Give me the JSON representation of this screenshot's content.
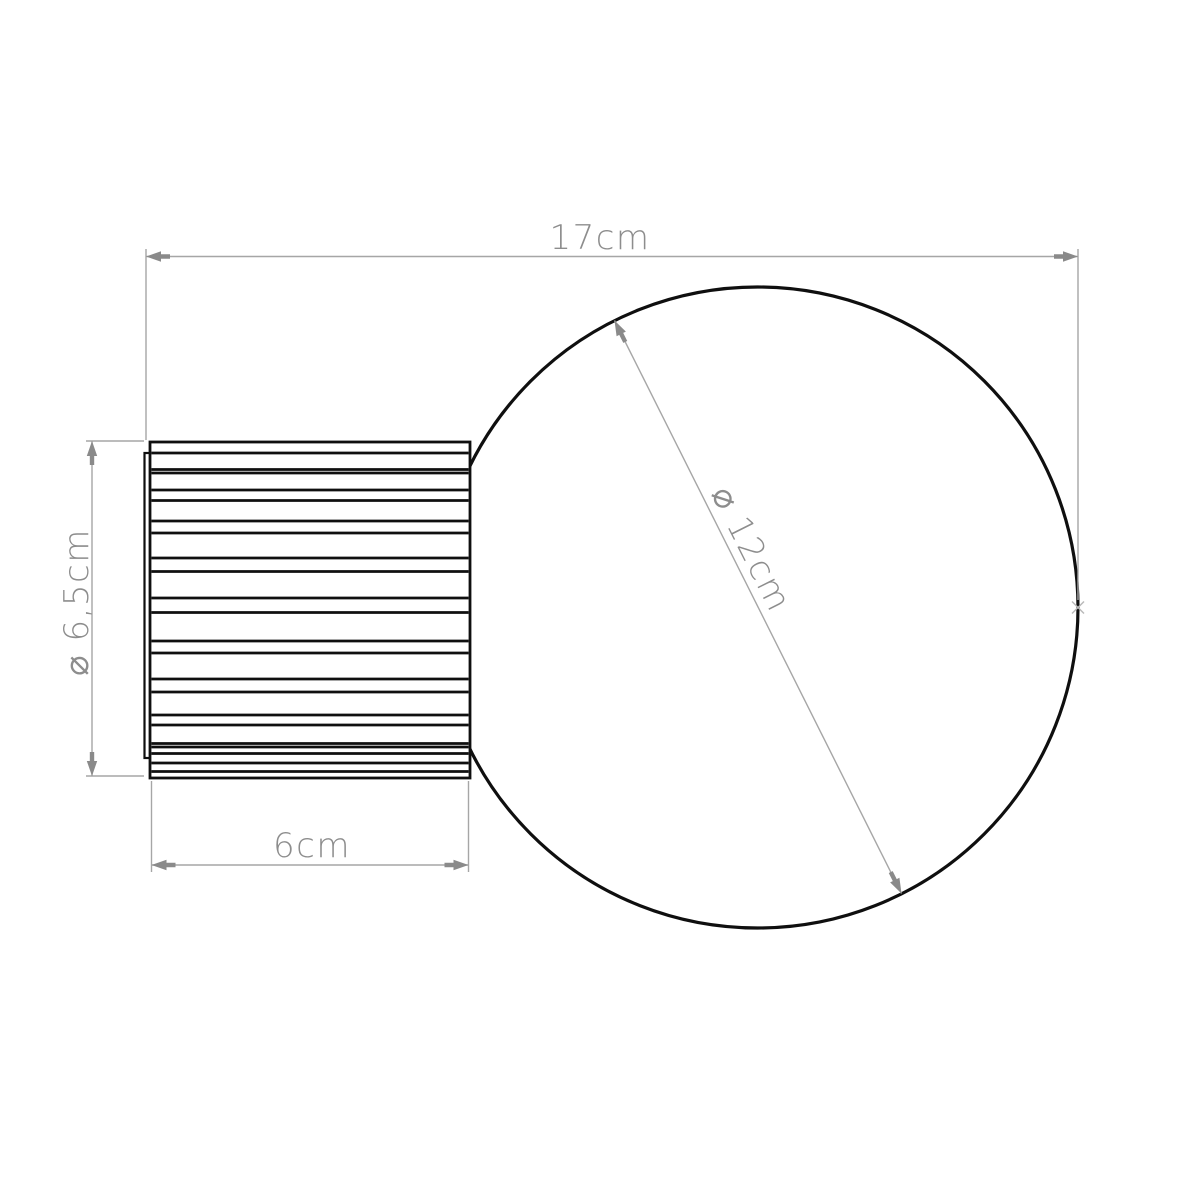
{
  "colors": {
    "outline": "#0f0f0f",
    "dim_line": "#a6a6a6",
    "dim_text": "#8d8d8d",
    "arrow": "#8a8a8a",
    "background": "#ffffff"
  },
  "labels": {
    "total_width": "17cm",
    "body_diameter": "⌀ 6,5cm",
    "body_depth": "6cm",
    "globe_diameter": "⌀ 12cm"
  },
  "dimensions_cm": {
    "total_width": 17,
    "body_diameter": 6.5,
    "body_depth": 6,
    "globe_diameter": 12
  },
  "drawing": {
    "globe": {
      "cx": 757.5,
      "cy": 607.5,
      "r": 320.5
    },
    "body": {
      "x": 150,
      "y": 442,
      "width": 320,
      "height": 336
    },
    "backplate": {
      "x": 144.5,
      "y": 453,
      "width": 8,
      "height": 305
    },
    "rib_lines_y": [
      453,
      469.5,
      473,
      490,
      500.5,
      521,
      533,
      558,
      571.5,
      598,
      612.5,
      641,
      653,
      679,
      692,
      715,
      725,
      743.5,
      747,
      753.5,
      763,
      771.5
    ]
  }
}
